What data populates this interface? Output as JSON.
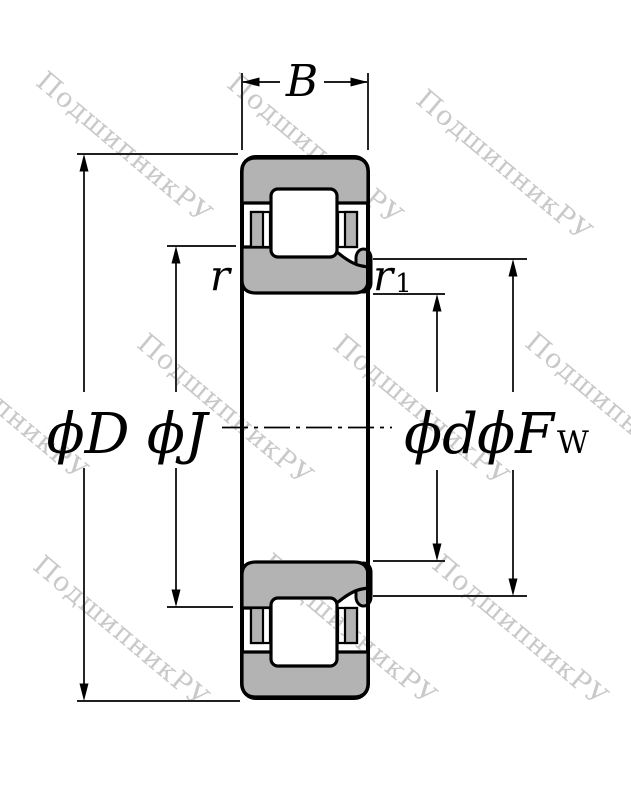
{
  "labels": {
    "width": "B",
    "outer_diameter": "ϕD",
    "pitch_diameter": "ϕJ",
    "bore_diameter": "ϕd",
    "raceway_main": "ϕF",
    "raceway_sub": "W",
    "outer_chamfer": "r",
    "inner_chamfer_main": "r",
    "inner_chamfer_sub": "1"
  },
  "colors": {
    "ring_fill": "#b3b3b3",
    "line": "#000000",
    "background": "#ffffff",
    "watermark": "#c9c9c9"
  },
  "watermark": {
    "text": "ПодшипникРУ",
    "angle_deg": 40,
    "positions": [
      [
        124,
        148
      ],
      [
        315,
        150
      ],
      [
        504,
        166
      ],
      [
        0,
        405
      ],
      [
        225,
        410
      ],
      [
        421,
        411
      ],
      [
        613,
        409
      ],
      [
        121,
        632
      ],
      [
        349,
        630
      ],
      [
        520,
        631
      ]
    ]
  }
}
